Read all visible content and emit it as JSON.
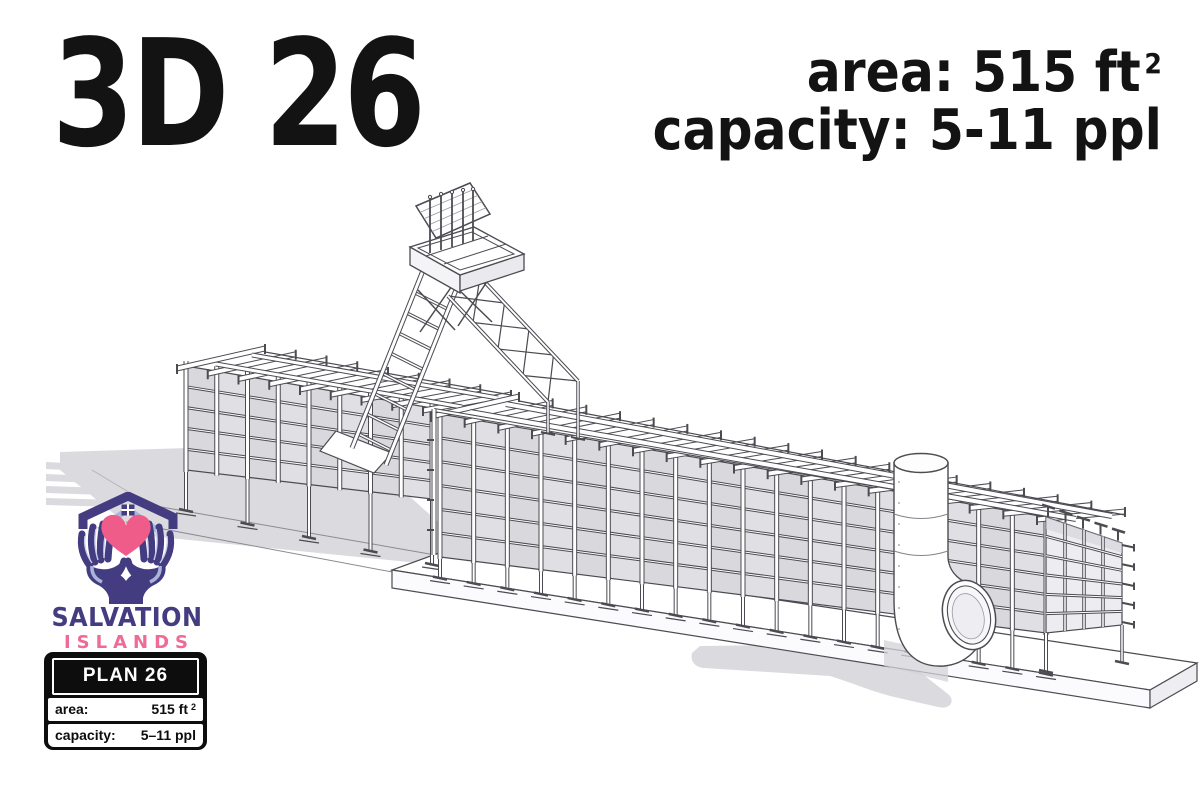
{
  "sheet": {
    "title": "3D 26"
  },
  "specs": {
    "rows": [
      {
        "label": "area:",
        "value": "515 ft",
        "sup": "2"
      },
      {
        "label": "capacity:",
        "value": "5-11 ppl",
        "sup": ""
      }
    ]
  },
  "logo": {
    "line1": "SALVATION",
    "line2": "ISLANDS"
  },
  "plan_card": {
    "title": "PLAN 26",
    "rows": [
      {
        "label": "area:",
        "value": "515 ft",
        "sup": "2"
      },
      {
        "label": "capacity:",
        "value": "5–11 ppl",
        "sup": ""
      }
    ]
  },
  "drawing": {
    "alt": "Isometric 3D line drawing of plan 26: a long modular steel-frame structure on a concrete plinth with a stair ramp rising to a rooftop hatch platform and a cylindrical tank with elbow duct"
  },
  "colors": {
    "ink": "#131313",
    "line": "#4b4b52",
    "panel": "#e0e0e4",
    "panel_shaded": "#ececf1",
    "shadow": "#dbdbdf",
    "brand_purple": "#443c80",
    "brand_pink": "#ef6a94",
    "periwinkle": "#a9b4da",
    "heart_pink": "#ef5c8a"
  }
}
